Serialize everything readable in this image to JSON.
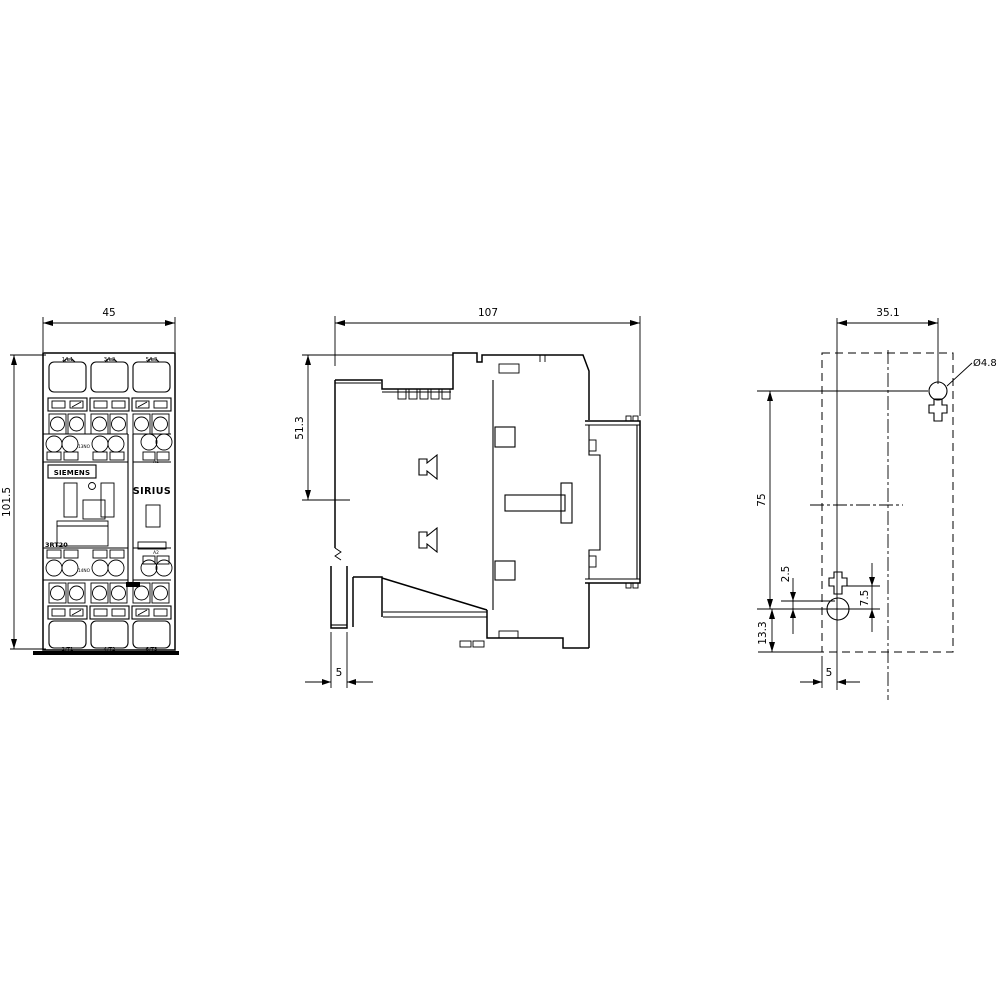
{
  "drawing": {
    "front_view": {
      "width_dim": "45",
      "height_dim": "101.5",
      "brand": "SIEMENS",
      "series": "SIRIUS",
      "model": "3RT20",
      "top_terminals": [
        "1/L1",
        "3/L2",
        "5/L3"
      ],
      "bottom_terminals": [
        "2/T1",
        "4/T2",
        "6/T3"
      ],
      "aux_upper_label": "13NO",
      "aux_lower_label": "14NO",
      "coil_upper_label": "A1",
      "coil_lower_label": "A2"
    },
    "side_view": {
      "width_dim": "107",
      "height_dim": "51.3",
      "rail_foot_dim": "5"
    },
    "drill_plan": {
      "hole_spacing_h": "35.1",
      "hole_diameter": "Ø4.8",
      "hole_spacing_v": "75",
      "slot_offset": "2.5",
      "keyhole_offset": "7.5",
      "bottom_offset": "13.3",
      "edge_offset": "5"
    }
  },
  "colors": {
    "line": "#000000",
    "background": "#ffffff"
  }
}
